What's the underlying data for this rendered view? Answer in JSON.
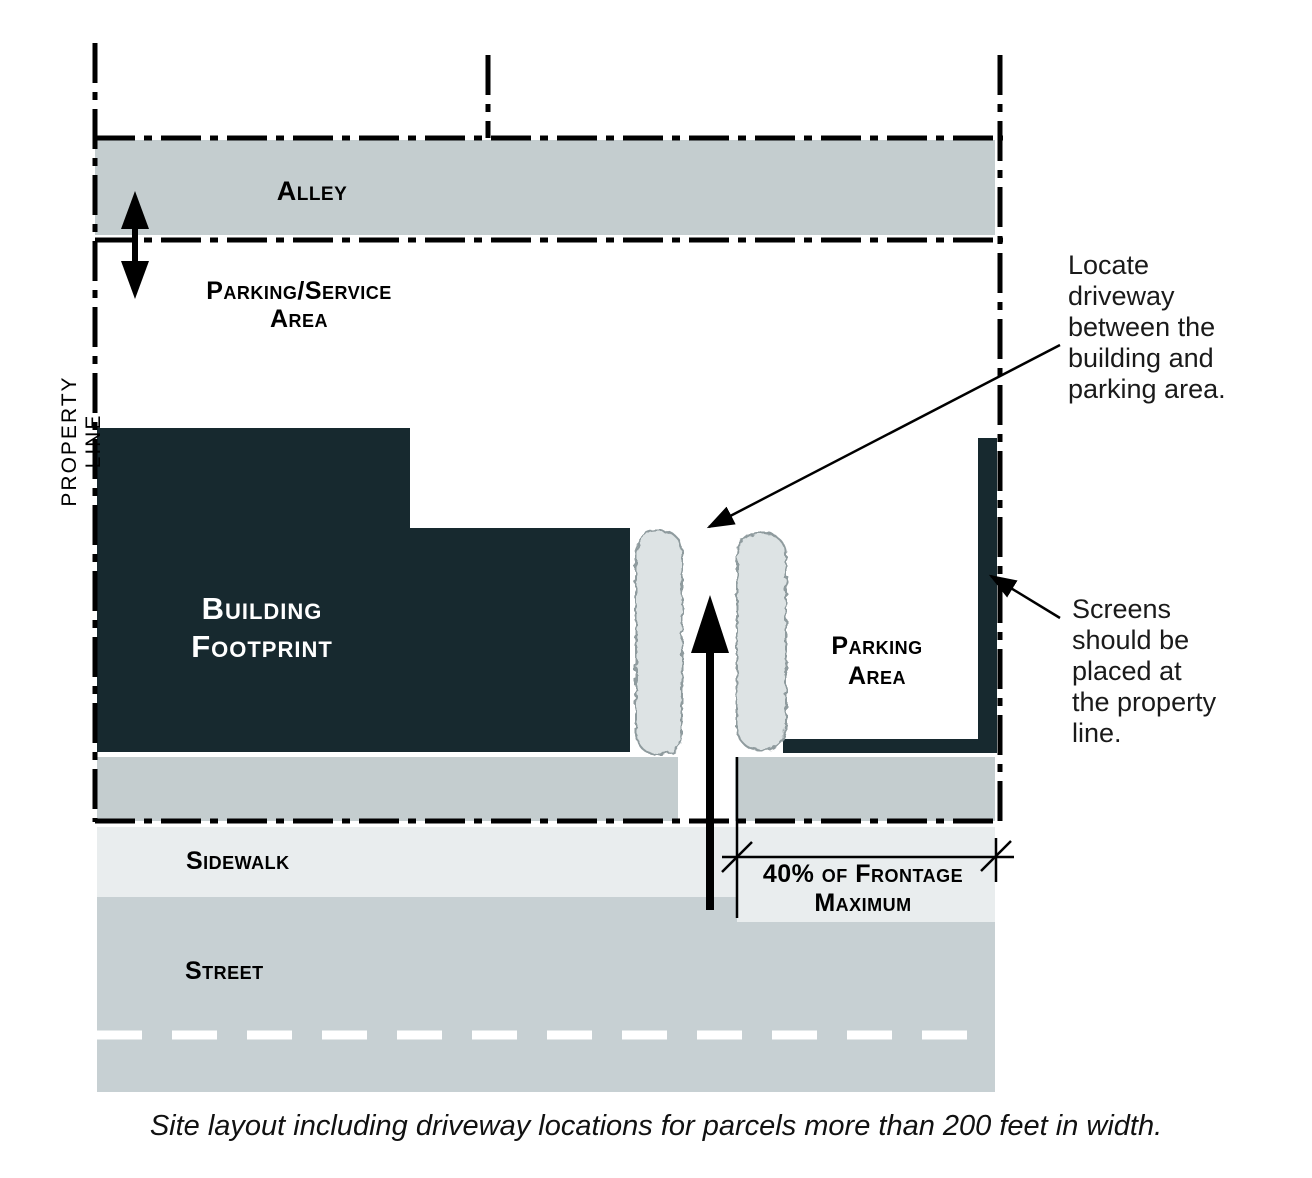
{
  "diagram": {
    "caption": "Site layout including driveway locations for parcels more than 200 feet in width.",
    "labels": {
      "alley": "Alley",
      "parking_service_line1": "Parking/Service",
      "parking_service_line2": "Area",
      "property_line": "PROPERTY LINE",
      "building_line1": "Building",
      "building_line2": "Footprint",
      "parking_area_line1": "Parking",
      "parking_area_line2": "Area",
      "sidewalk": "Sidewalk",
      "street": "Street",
      "frontage_line1": "40% of Frontage",
      "frontage_line2": "Maximum"
    },
    "annotations": {
      "locate_driveway": {
        "lines": [
          "Locate",
          "driveway",
          "between the",
          "building and",
          "parking area."
        ]
      },
      "screens": {
        "lines": [
          "Screens",
          "should be",
          "placed at",
          "the property",
          "line."
        ]
      }
    },
    "colors": {
      "building": "#17292f",
      "road_gray": "#c4cdcf",
      "street_gray": "#c7d0d3",
      "sidewalk": "#e9edee",
      "hedge_fill": "#dde3e4",
      "hedge_stroke": "#8f9b9e",
      "line_black": "#000000",
      "centerline_white": "#ffffff"
    }
  }
}
